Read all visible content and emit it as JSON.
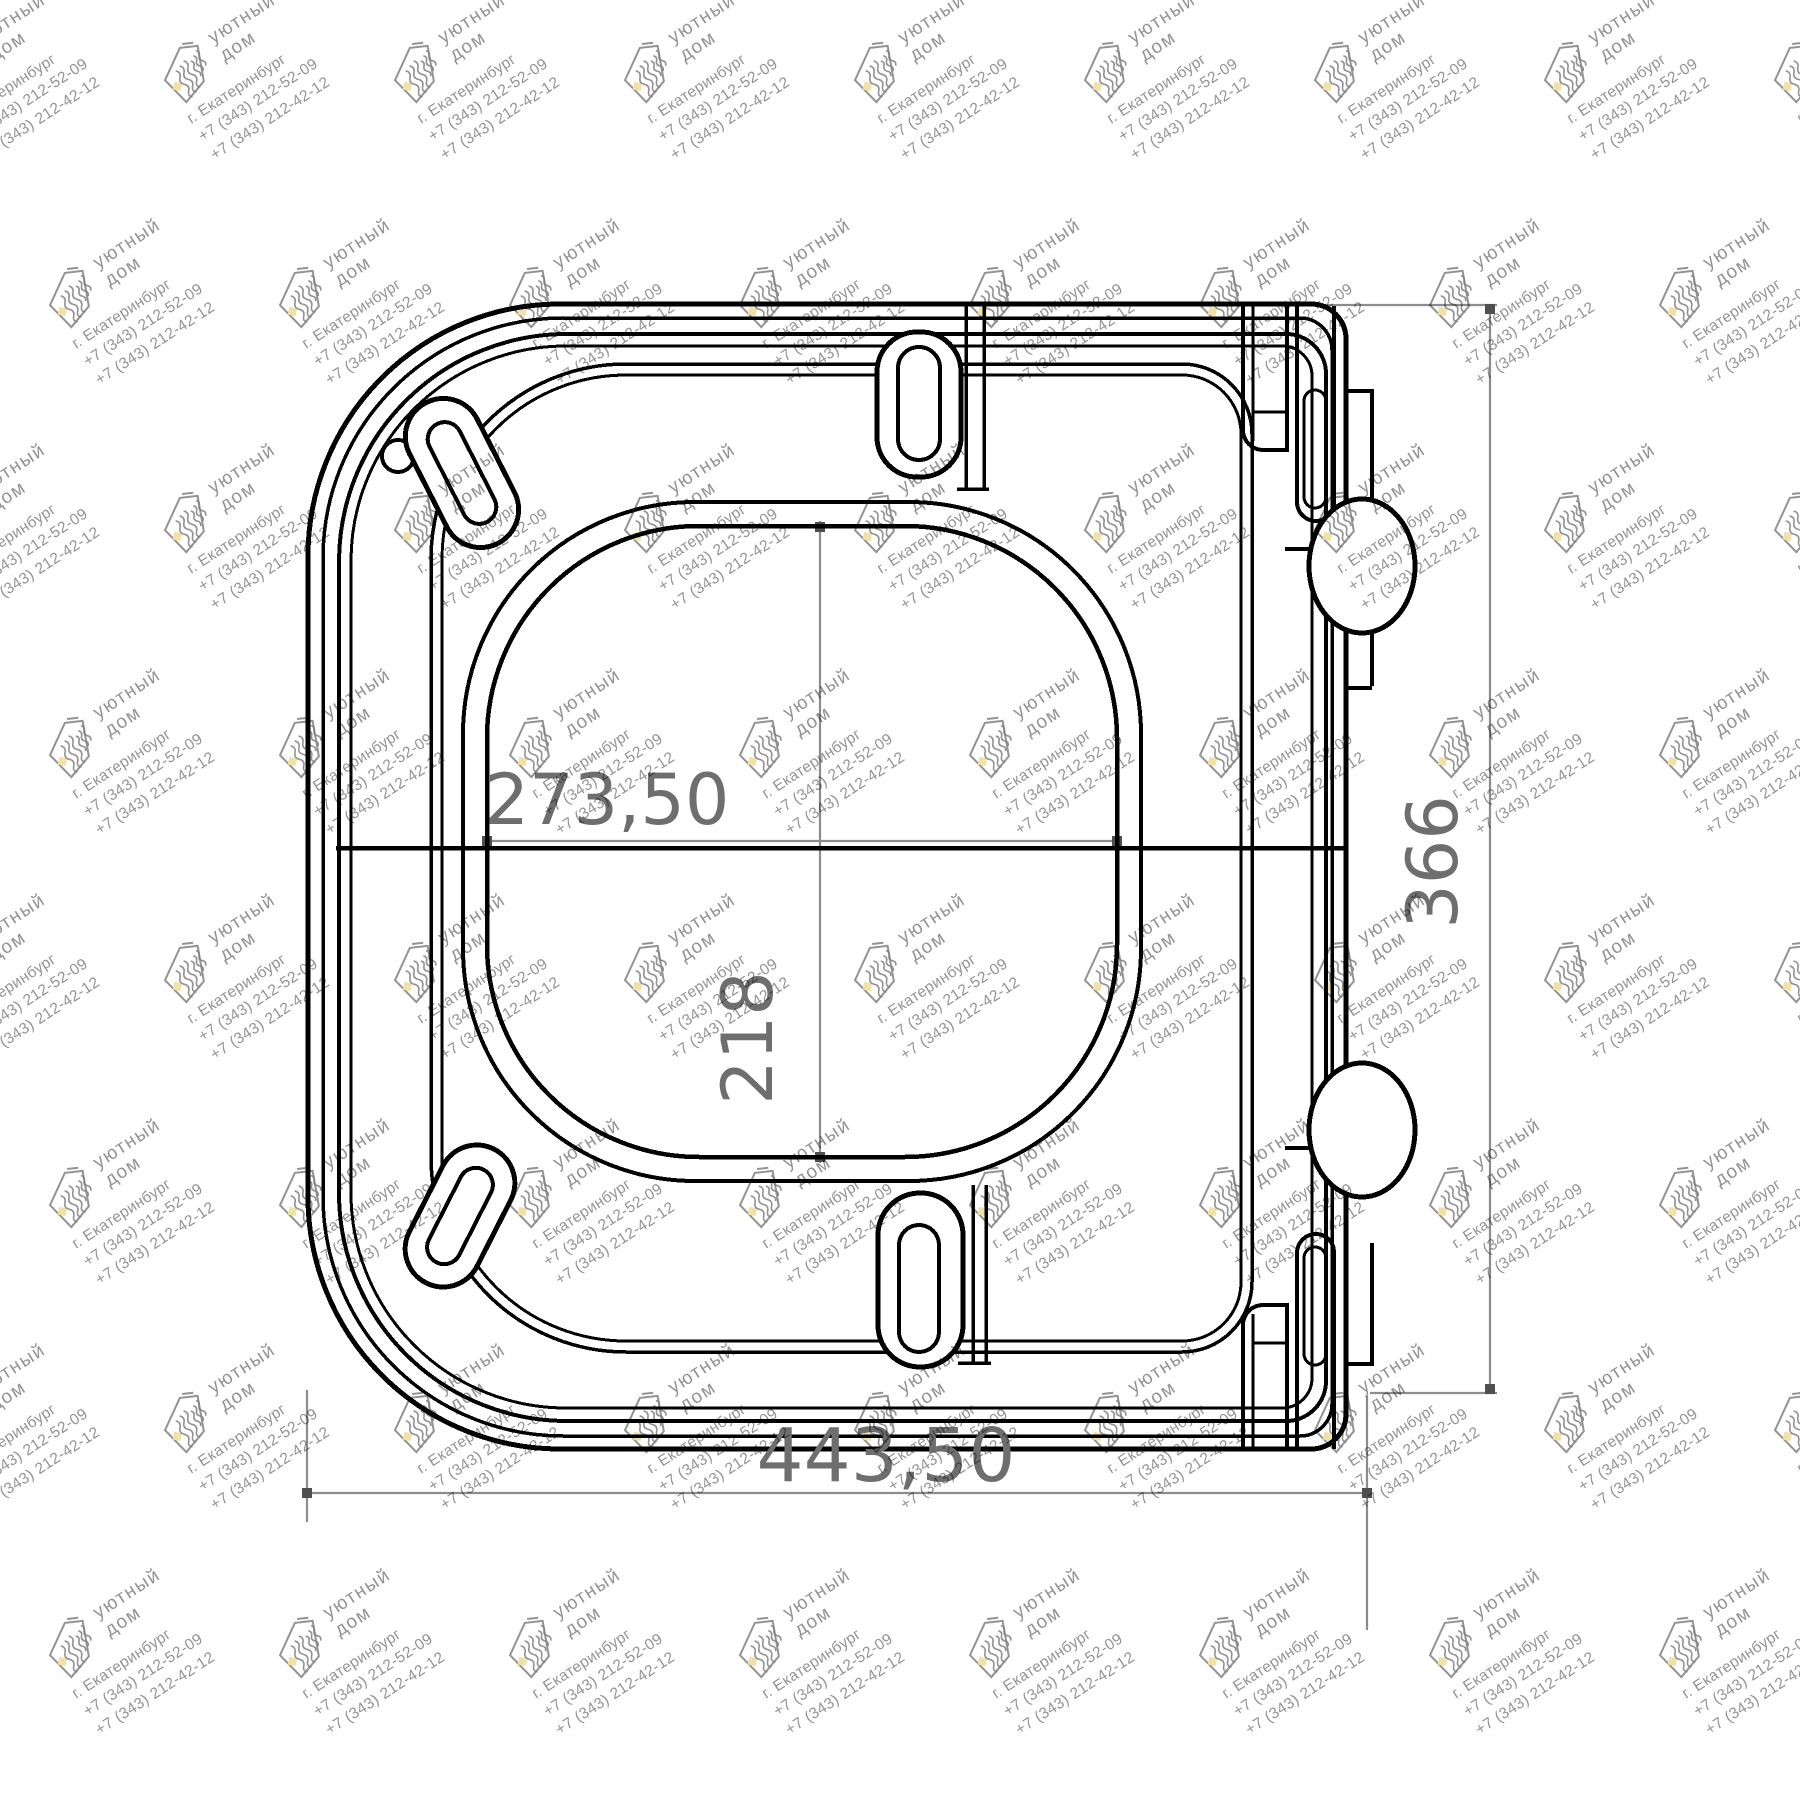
{
  "drawing": {
    "line_color": "#000000",
    "dimension_line_color": "#8c8c8c",
    "dimension_text_color": "#6e6e6e",
    "dimensions": {
      "inner_width": "273,50",
      "inner_height": "218",
      "overall_width": "443,50",
      "overall_height": "366"
    }
  },
  "watermark": {
    "text_color": "#808080",
    "accent_color": "#f0e2a6",
    "brand_line1": "уютный",
    "brand_line2": "дом",
    "city": "г. Екатеринбург",
    "phone1": "+7 (343) 212-52-09",
    "phone2": "+7 (343) 212-42-12"
  }
}
